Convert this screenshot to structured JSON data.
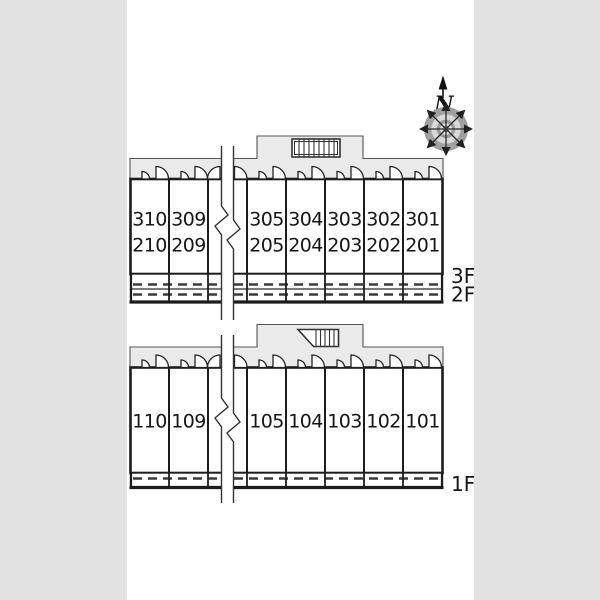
{
  "page": {
    "background": "#e2e2e2",
    "panel_background": "#ffffff"
  },
  "compass": {
    "north_label": "N"
  },
  "upper_building": {
    "floor_labels": [
      "3F",
      "2F"
    ],
    "units": [
      {
        "line1": "310",
        "line2": "210"
      },
      {
        "line1": "309",
        "line2": "209"
      },
      {
        "line1": "305",
        "line2": "205"
      },
      {
        "line1": "304",
        "line2": "204"
      },
      {
        "line1": "303",
        "line2": "203"
      },
      {
        "line1": "302",
        "line2": "202"
      },
      {
        "line1": "301",
        "line2": "201"
      }
    ]
  },
  "lower_building": {
    "floor_labels": [
      "1F"
    ],
    "units": [
      {
        "line1": "110"
      },
      {
        "line1": "109"
      },
      {
        "line1": "105"
      },
      {
        "line1": "104"
      },
      {
        "line1": "103"
      },
      {
        "line1": "102"
      },
      {
        "line1": "101"
      }
    ]
  },
  "colors": {
    "wall": "#1c1c1c",
    "corridor_fill": "#eaeaea",
    "window_dash": "#3a3a3a",
    "compass_ring": "#a0a0a0"
  }
}
